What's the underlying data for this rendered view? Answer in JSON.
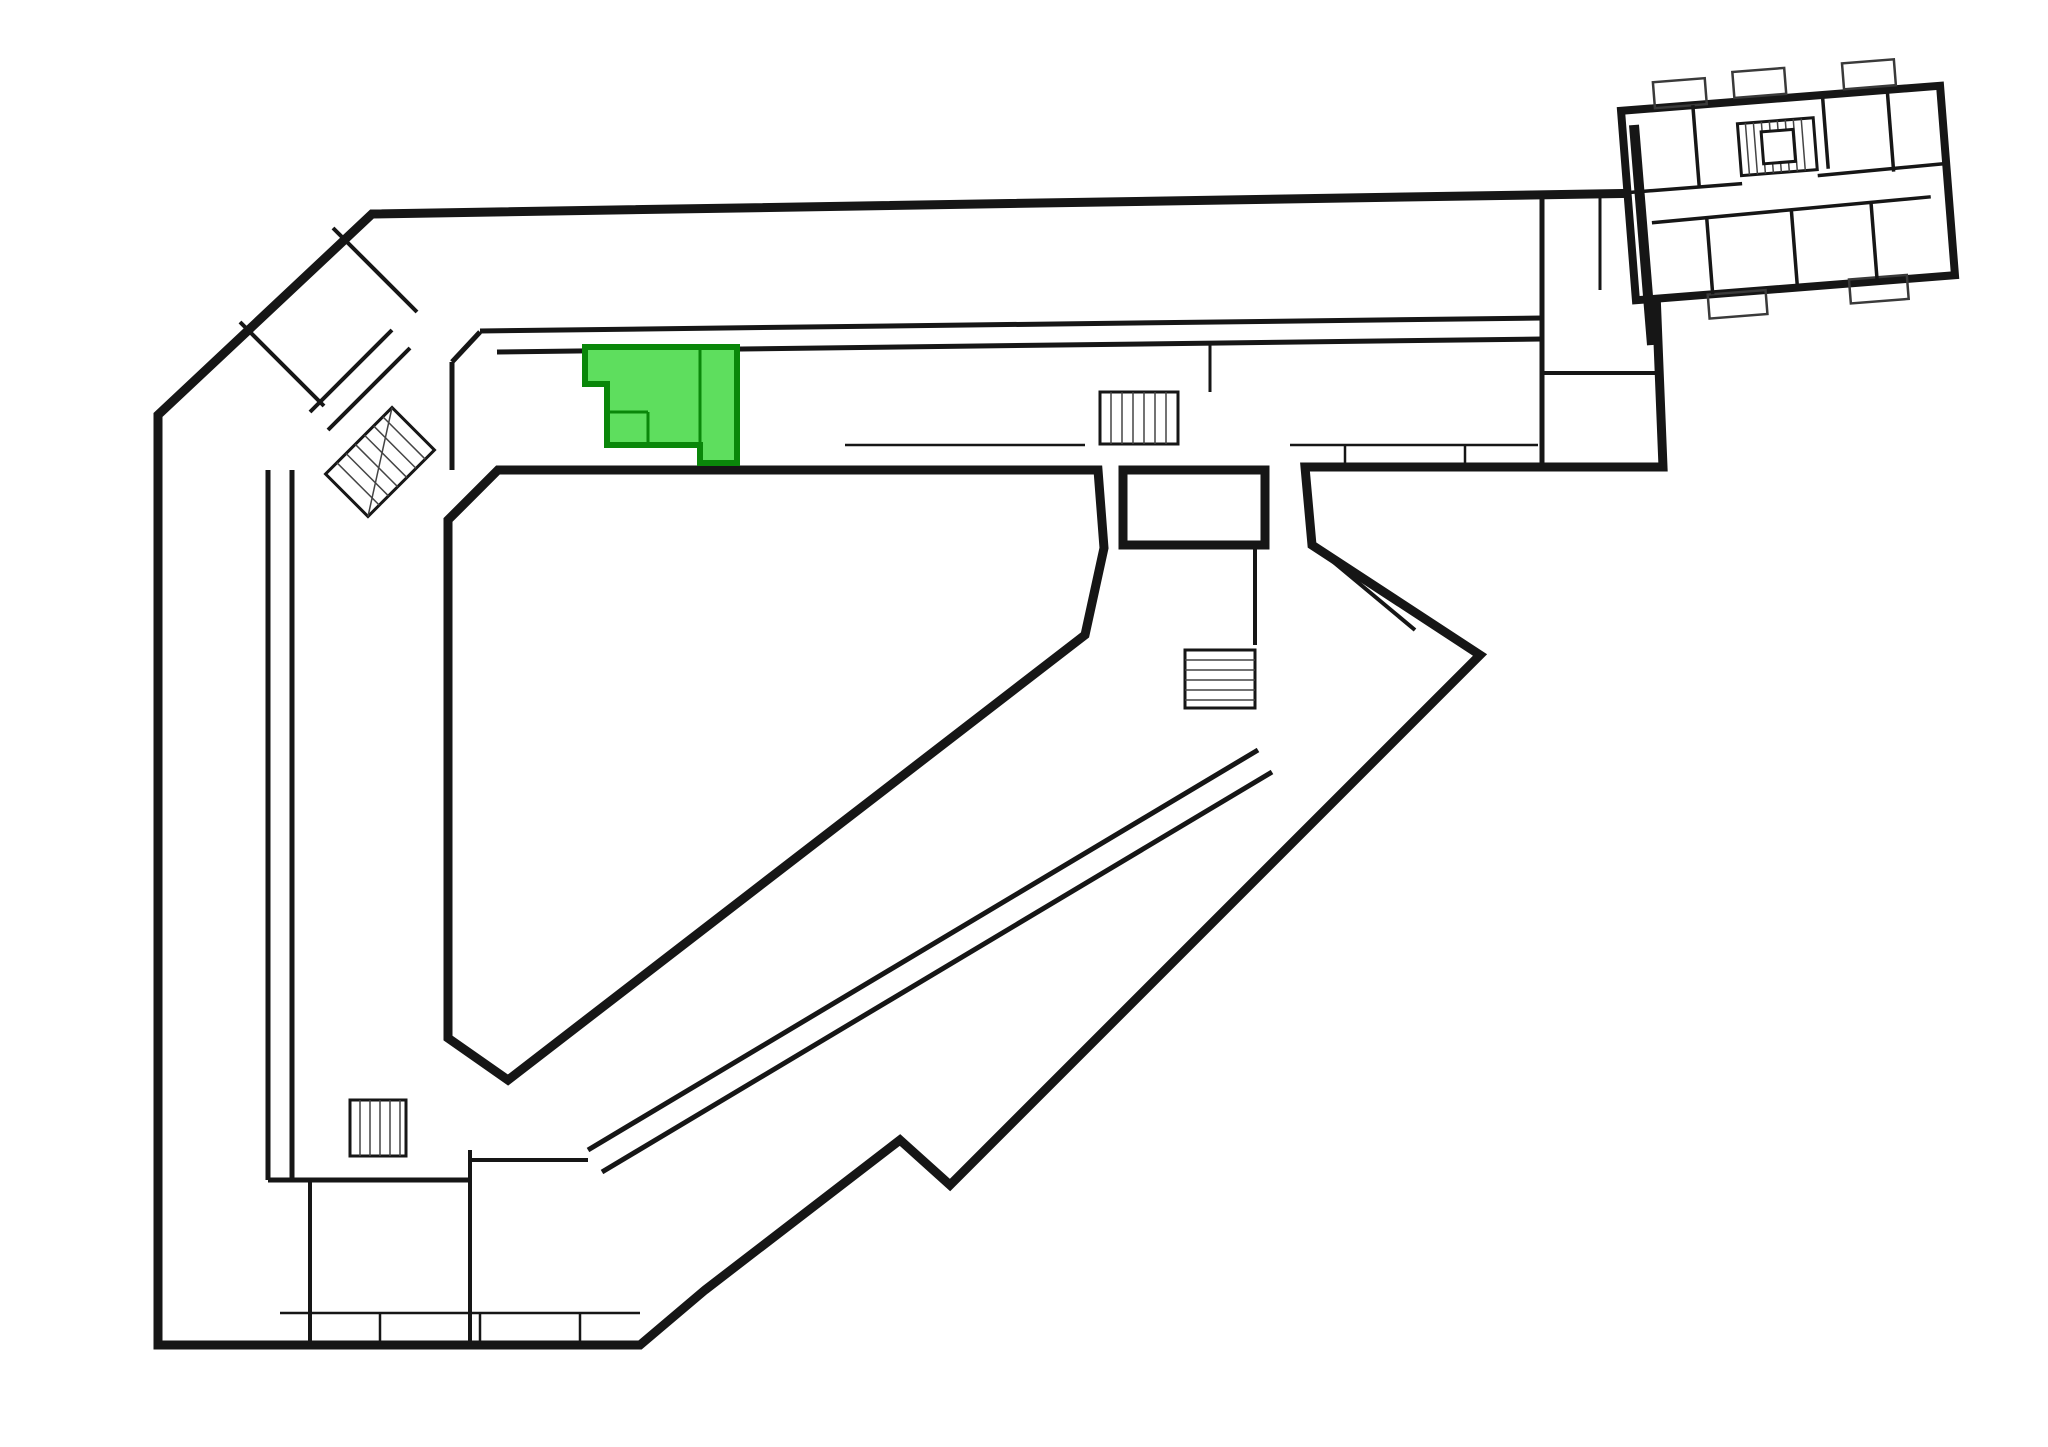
{
  "floor_plan": {
    "description": "apartment building floor plan",
    "highlighted_room": "129",
    "highlight_fill": "#5ede5e",
    "highlight_wall_color": "#0a870a",
    "rooms": [
      {
        "id": "124",
        "x": 431,
        "y": 274
      },
      {
        "id": "125",
        "x": 519,
        "y": 275
      },
      {
        "id": "126",
        "x": 607,
        "y": 275
      },
      {
        "id": "127",
        "x": 694,
        "y": 276
      },
      {
        "id": "123",
        "x": 329,
        "y": 316
      },
      {
        "id": "122",
        "x": 235,
        "y": 411
      },
      {
        "id": "128",
        "x": 793,
        "y": 340
      },
      {
        "id": "129",
        "x": 672,
        "y": 392,
        "highlight": true
      },
      {
        "id": "130",
        "x": 539,
        "y": 398
      },
      {
        "id": "224",
        "x": 880,
        "y": 272
      },
      {
        "id": "225",
        "x": 967,
        "y": 272
      },
      {
        "id": "226",
        "x": 1054,
        "y": 272
      },
      {
        "id": "227",
        "x": 1141,
        "y": 272
      },
      {
        "id": "228",
        "x": 1228,
        "y": 272
      },
      {
        "id": "229",
        "x": 1315,
        "y": 272
      },
      {
        "id": "230",
        "x": 1407,
        "y": 271
      },
      {
        "id": "231",
        "x": 1492,
        "y": 270
      },
      {
        "id": "232",
        "x": 1593,
        "y": 337
      },
      {
        "id": "233",
        "x": 1468,
        "y": 388
      },
      {
        "id": "234",
        "x": 1350,
        "y": 387
      },
      {
        "id": "235",
        "x": 1051,
        "y": 387
      },
      {
        "id": "236",
        "x": 965,
        "y": 388
      },
      {
        "id": "237",
        "x": 878,
        "y": 388
      },
      {
        "id": "121",
        "x": 215,
        "y": 567
      },
      {
        "id": "131",
        "x": 363,
        "y": 585
      },
      {
        "id": "132",
        "x": 350,
        "y": 703
      },
      {
        "id": "120",
        "x": 213,
        "y": 737
      },
      {
        "id": "133",
        "x": 342,
        "y": 799
      },
      {
        "id": "20",
        "x": 337,
        "y": 867
      },
      {
        "id": "19",
        "x": 209,
        "y": 914
      },
      {
        "id": "21",
        "x": 349,
        "y": 966
      },
      {
        "id": "18",
        "x": 205,
        "y": 1043
      },
      {
        "id": "22",
        "x": 347,
        "y": 1053
      },
      {
        "id": "17",
        "x": 205,
        "y": 1154
      },
      {
        "id": "16",
        "x": 252,
        "y": 1263
      },
      {
        "id": "30",
        "x": 390,
        "y": 1242
      },
      {
        "id": "29",
        "x": 585,
        "y": 1234
      },
      {
        "id": "23",
        "x": 567,
        "y": 1088
      },
      {
        "id": "24",
        "x": 643,
        "y": 1038
      },
      {
        "id": "25",
        "x": 720,
        "y": 992
      },
      {
        "id": "26",
        "x": 804,
        "y": 944
      },
      {
        "id": "27",
        "x": 859,
        "y": 1064
      },
      {
        "id": "28",
        "x": 722,
        "y": 1152
      },
      {
        "id": "300",
        "x": 884,
        "y": 896
      },
      {
        "id": "301",
        "x": 964,
        "y": 845
      },
      {
        "id": "302",
        "x": 1034,
        "y": 798
      },
      {
        "id": "303",
        "x": 1117,
        "y": 751
      },
      {
        "id": "304",
        "x": 1192,
        "y": 586
      },
      {
        "id": "305",
        "x": 1306,
        "y": 582
      },
      {
        "id": "306",
        "x": 1395,
        "y": 682
      },
      {
        "id": "307",
        "x": 1320,
        "y": 778
      },
      {
        "id": "308",
        "x": 1201,
        "y": 858
      },
      {
        "id": "309",
        "x": 1092,
        "y": 921
      },
      {
        "id": "310",
        "x": 968,
        "y": 1002
      }
    ],
    "tiny_annotations": [
      {
        "x": 1082,
        "y": 473
      },
      {
        "x": 1334,
        "y": 471
      }
    ]
  }
}
